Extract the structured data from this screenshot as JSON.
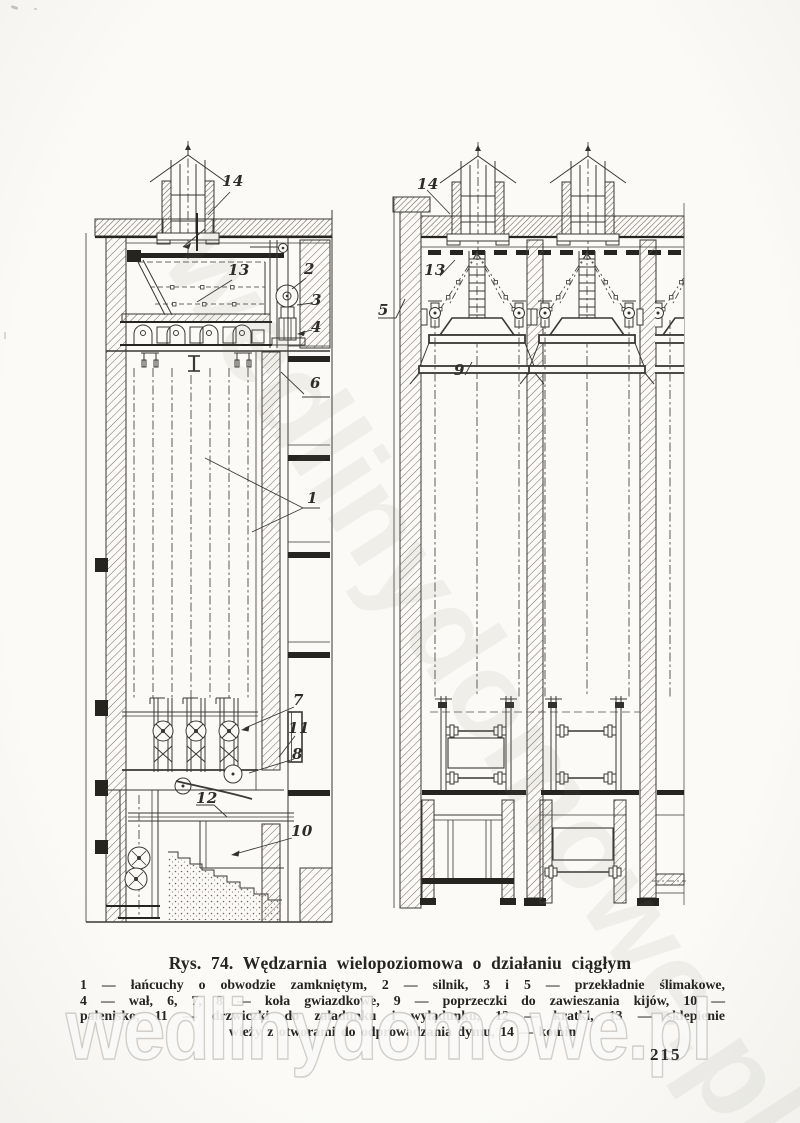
{
  "page": {
    "number": "215"
  },
  "watermark": {
    "text": "wedlinydomowe.pl"
  },
  "figure": {
    "title": "Rys. 74. Wędzarnia wielopoziomowa o działaniu ciągłym",
    "caption_lines": [
      "1 — łańcuchy o obwodzie zamkniętym, 2 — silnik, 3 i 5 — przekładnie ślimakowe,",
      "4 — wał, 6, 7, 8 — koła gwiazdkowe, 9 — poprzeczki do zawieszania kijów, 10 —",
      "palenisko, 11 — drzwiczki do załadunku i wyładunku, 12 — kratki, 13 — sklepienie",
      "wieży z otworami do odprowadzania dymu, 14 — komin"
    ],
    "left_labels": [
      "14",
      "13",
      "2",
      "3",
      "4",
      "6",
      "1",
      "7",
      "11",
      "8",
      "12",
      "10"
    ],
    "right_labels": [
      "14",
      "13",
      "5",
      "9"
    ]
  },
  "colors": {
    "paper": "#fbfaf6",
    "ink": "#33312c"
  }
}
